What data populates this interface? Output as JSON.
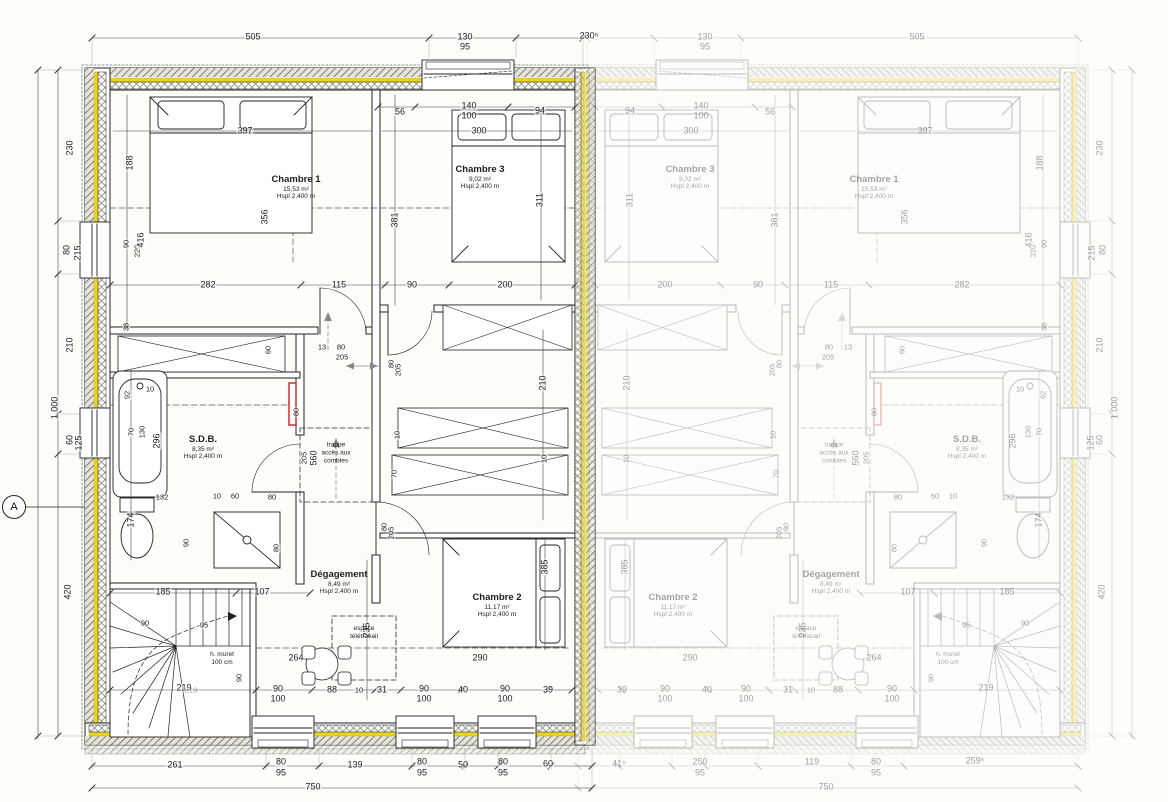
{
  "drawing": {
    "type": "architectural-floor-plan",
    "units": {
      "left": "active",
      "right": "mirrored-faded"
    },
    "scale_note": "750"
  },
  "colors": {
    "insulation_yellow": "#e9d61d",
    "highlight_red": "#c93030",
    "line": "#222222",
    "faded_opacity": "0.35"
  },
  "rooms": [
    {
      "id": "chambre1",
      "name": "Chambre 1",
      "area": "15,53 m²",
      "height": "Hspl 2,400 m",
      "x": 296,
      "y": 188
    },
    {
      "id": "chambre3",
      "name": "Chambre 3",
      "area": "9,02 m²",
      "height": "Hspl 2,400 m",
      "x": 480,
      "y": 178
    },
    {
      "id": "sdb",
      "name": "S.D.B.",
      "area": "8,35 m²",
      "height": "Hspl 2,400 m",
      "x": 203,
      "y": 448
    },
    {
      "id": "degagement",
      "name": "Dégagement",
      "area": "8,49 m²",
      "height": "Hspl 2,400 m",
      "x": 339,
      "y": 583
    },
    {
      "id": "chambre2",
      "name": "Chambre 2",
      "area": "11,17 m²",
      "height": "Hspl 2,400 m",
      "x": 497,
      "y": 606
    }
  ],
  "annotations": [
    {
      "id": "trappe",
      "text": "trappe\naccès aux\ncombles",
      "x": 336,
      "y": 453
    },
    {
      "id": "espace",
      "text": "espace\ntélétravail",
      "x": 364,
      "y": 633
    },
    {
      "id": "muret",
      "text": "h. muret\n100 cm",
      "x": 222,
      "y": 659
    },
    {
      "id": "section",
      "text": "A",
      "x": 14,
      "y": 507,
      "m": 0
    }
  ],
  "dim_labels": [
    {
      "t": "505",
      "x": 253,
      "y": 37
    },
    {
      "t": "130",
      "x": 465,
      "y": 37
    },
    {
      "t": "95",
      "x": 465,
      "y": 47
    },
    {
      "t": "230⁵",
      "x": 589,
      "y": 36,
      "m": 0
    },
    {
      "t": "56",
      "x": 400,
      "y": 112
    },
    {
      "t": "140",
      "x": 469,
      "y": 106
    },
    {
      "t": "100",
      "x": 469,
      "y": 116
    },
    {
      "t": "94",
      "x": 540,
      "y": 111
    },
    {
      "t": "397",
      "x": 245,
      "y": 131
    },
    {
      "t": "300",
      "x": 479,
      "y": 131
    },
    {
      "t": "230",
      "x": 70,
      "y": 148,
      "v": 1
    },
    {
      "t": "80",
      "x": 67,
      "y": 250,
      "v": 1
    },
    {
      "t": "215",
      "x": 78,
      "y": 253,
      "v": 1
    },
    {
      "t": "210",
      "x": 70,
      "y": 345,
      "v": 1
    },
    {
      "t": "60",
      "x": 70,
      "y": 440,
      "v": 1
    },
    {
      "t": "125",
      "x": 79,
      "y": 443,
      "v": 1
    },
    {
      "t": "420",
      "x": 68,
      "y": 592,
      "v": 1
    },
    {
      "t": "1.000",
      "x": 55,
      "y": 408,
      "v": 1
    },
    {
      "t": "188",
      "x": 130,
      "y": 163,
      "v": 1
    },
    {
      "t": "90",
      "x": 126,
      "y": 244,
      "v": 1,
      "s": 1
    },
    {
      "t": "220",
      "x": 137,
      "y": 251,
      "v": 1,
      "s": 1
    },
    {
      "t": "416",
      "x": 141,
      "y": 240,
      "v": 1
    },
    {
      "t": "356",
      "x": 265,
      "y": 217,
      "v": 1
    },
    {
      "t": "38",
      "x": 126,
      "y": 327,
      "v": 1,
      "s": 1
    },
    {
      "t": "311",
      "x": 540,
      "y": 200,
      "v": 1
    },
    {
      "t": "381",
      "x": 395,
      "y": 220,
      "v": 1
    },
    {
      "t": "282",
      "x": 208,
      "y": 285
    },
    {
      "t": "115",
      "x": 339,
      "y": 285
    },
    {
      "t": "90",
      "x": 412,
      "y": 285
    },
    {
      "t": "200",
      "x": 505,
      "y": 285
    },
    {
      "t": "60",
      "x": 268,
      "y": 350,
      "v": 1,
      "s": 1
    },
    {
      "t": "13",
      "x": 322,
      "y": 347,
      "s": 1
    },
    {
      "t": "80",
      "x": 341,
      "y": 347,
      "s": 1
    },
    {
      "t": "205",
      "x": 342,
      "y": 357,
      "s": 1
    },
    {
      "t": "80",
      "x": 391,
      "y": 364,
      "v": 1,
      "s": 1
    },
    {
      "t": "205",
      "x": 398,
      "y": 370,
      "v": 1,
      "s": 1
    },
    {
      "t": "210",
      "x": 543,
      "y": 383,
      "v": 1
    },
    {
      "t": "10",
      "x": 397,
      "y": 435,
      "v": 1,
      "s": 1
    },
    {
      "t": "70",
      "x": 394,
      "y": 474,
      "v": 1,
      "s": 1
    },
    {
      "t": "10",
      "x": 544,
      "y": 459,
      "v": 1,
      "s": 1
    },
    {
      "t": "92",
      "x": 127,
      "y": 395,
      "v": 1,
      "s": 1
    },
    {
      "t": "10",
      "x": 150,
      "y": 389,
      "s": 1
    },
    {
      "t": "70",
      "x": 131,
      "y": 432,
      "v": 1,
      "s": 1
    },
    {
      "t": "130",
      "x": 142,
      "y": 432,
      "v": 1,
      "s": 1
    },
    {
      "t": "296",
      "x": 157,
      "y": 441,
      "v": 1
    },
    {
      "t": "80",
      "x": 296,
      "y": 412,
      "v": 1,
      "s": 1
    },
    {
      "t": "205",
      "x": 304,
      "y": 458,
      "v": 1,
      "s": 1
    },
    {
      "t": "560",
      "x": 314,
      "y": 458,
      "v": 1
    },
    {
      "t": "132",
      "x": 162,
      "y": 497,
      "s": 1
    },
    {
      "t": "10",
      "x": 217,
      "y": 496,
      "s": 1
    },
    {
      "t": "60",
      "x": 235,
      "y": 496,
      "s": 1
    },
    {
      "t": "80",
      "x": 272,
      "y": 497,
      "s": 1
    },
    {
      "t": "174",
      "x": 131,
      "y": 520,
      "v": 1
    },
    {
      "t": "90",
      "x": 186,
      "y": 543,
      "v": 1,
      "s": 1
    },
    {
      "t": "80",
      "x": 276,
      "y": 548,
      "v": 1,
      "s": 1
    },
    {
      "t": "80",
      "x": 384,
      "y": 527,
      "v": 1,
      "s": 1
    },
    {
      "t": "205",
      "x": 391,
      "y": 533,
      "v": 1,
      "s": 1
    },
    {
      "t": "385",
      "x": 545,
      "y": 567,
      "v": 1
    },
    {
      "t": "235",
      "x": 367,
      "y": 630,
      "v": 1
    },
    {
      "t": "185",
      "x": 163,
      "y": 592
    },
    {
      "t": "107",
      "x": 262,
      "y": 592
    },
    {
      "t": "90",
      "x": 145,
      "y": 623,
      "s": 1
    },
    {
      "t": "95",
      "x": 204,
      "y": 625,
      "s": 1
    },
    {
      "t": "90",
      "x": 239,
      "y": 678,
      "v": 1,
      "s": 1
    },
    {
      "t": "219",
      "x": 184,
      "y": 688
    },
    {
      "t": "264",
      "x": 296,
      "y": 658
    },
    {
      "t": "290",
      "x": 480,
      "y": 658
    },
    {
      "t": "219",
      "x": 191,
      "y": 690,
      "m": 0,
      "f": 1,
      "s": 1
    },
    {
      "t": "90",
      "x": 278,
      "y": 689
    },
    {
      "t": "100",
      "x": 278,
      "y": 699
    },
    {
      "t": "88",
      "x": 332,
      "y": 690
    },
    {
      "t": "10",
      "x": 359,
      "y": 690,
      "s": 1
    },
    {
      "t": "31",
      "x": 382,
      "y": 690
    },
    {
      "t": "90",
      "x": 424,
      "y": 689
    },
    {
      "t": "100",
      "x": 424,
      "y": 699
    },
    {
      "t": "40",
      "x": 463,
      "y": 690
    },
    {
      "t": "90",
      "x": 505,
      "y": 689
    },
    {
      "t": "100",
      "x": 505,
      "y": 699
    },
    {
      "t": "39",
      "x": 548,
      "y": 690
    },
    {
      "t": "261",
      "x": 175,
      "y": 765,
      "m": 0
    },
    {
      "t": "80",
      "x": 281,
      "y": 762,
      "m": 0
    },
    {
      "t": "95",
      "x": 281,
      "y": 773,
      "m": 0
    },
    {
      "t": "139",
      "x": 355,
      "y": 765,
      "m": 0
    },
    {
      "t": "80",
      "x": 422,
      "y": 762,
      "m": 0
    },
    {
      "t": "95",
      "x": 422,
      "y": 773,
      "m": 0
    },
    {
      "t": "50",
      "x": 463,
      "y": 765,
      "m": 0
    },
    {
      "t": "80",
      "x": 503,
      "y": 762,
      "m": 0
    },
    {
      "t": "95",
      "x": 503,
      "y": 773,
      "m": 0
    },
    {
      "t": "60",
      "x": 548,
      "y": 764,
      "m": 0
    },
    {
      "t": "750",
      "x": 313,
      "y": 787,
      "m": 0
    },
    {
      "t": "41⁵",
      "x": 619,
      "y": 764,
      "f": 1
    },
    {
      "t": "250",
      "x": 700,
      "y": 762,
      "f": 1
    },
    {
      "t": "95",
      "x": 700,
      "y": 773,
      "f": 1
    },
    {
      "t": "119",
      "x": 812,
      "y": 762,
      "f": 1
    },
    {
      "t": "80",
      "x": 876,
      "y": 762,
      "f": 1
    },
    {
      "t": "95",
      "x": 876,
      "y": 773,
      "f": 1
    },
    {
      "t": "259⁵",
      "x": 975,
      "y": 761,
      "f": 1
    },
    {
      "t": "750",
      "x": 826,
      "y": 787,
      "f": 1
    }
  ]
}
